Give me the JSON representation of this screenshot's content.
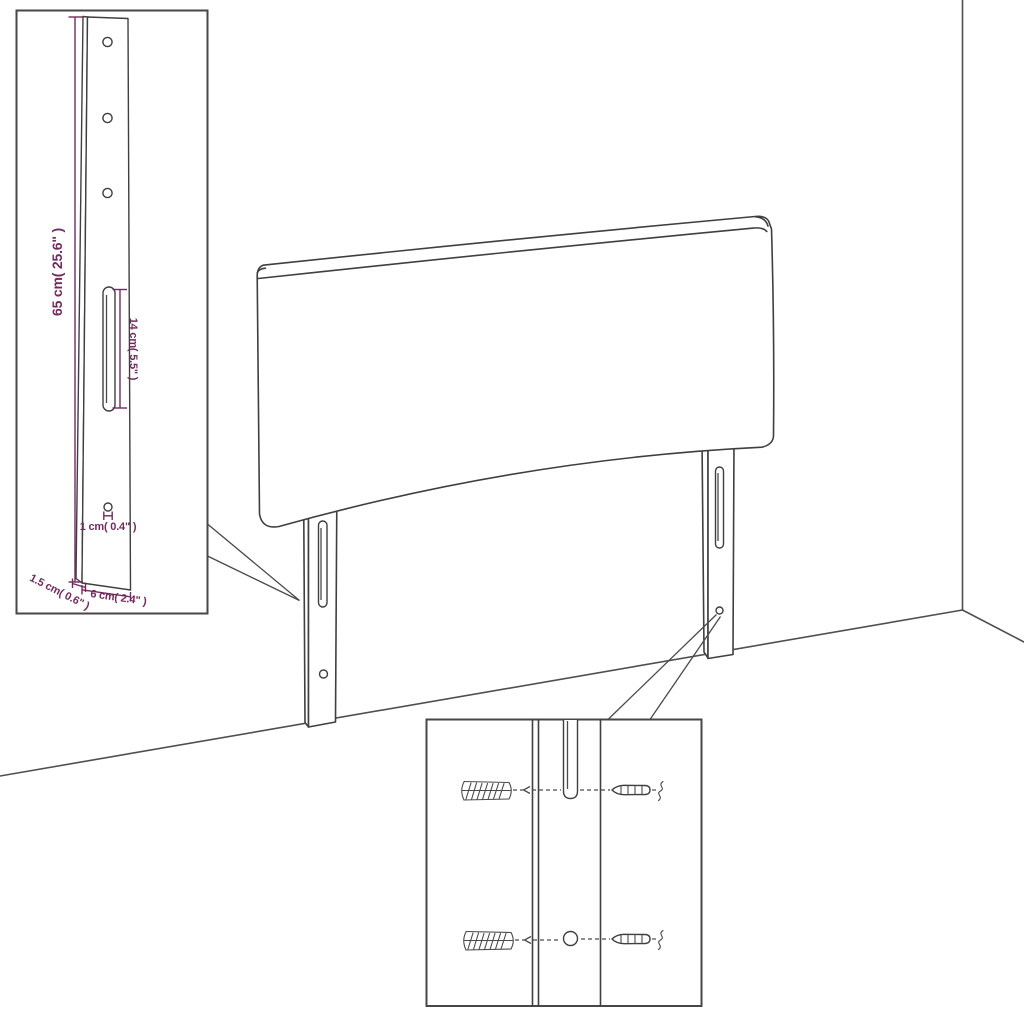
{
  "diagram": {
    "subject": "headboard-wall-mounting-instruction",
    "colors": {
      "line": "#3f3f3f",
      "wall_line": "#4f4f4f",
      "dimension_accent": "#722b5e",
      "background": "#ffffff"
    },
    "leg_detail_inset": {
      "dim_total_height": "65 cm( 25.6\" )",
      "dim_slot_length": "14 cm( 5.5\" )",
      "dim_hole": "1 cm( 0.4\" )",
      "dim_thickness": "1.5 cm( 0.6\" )",
      "dim_width": "6 cm( 2.4\" )"
    }
  }
}
